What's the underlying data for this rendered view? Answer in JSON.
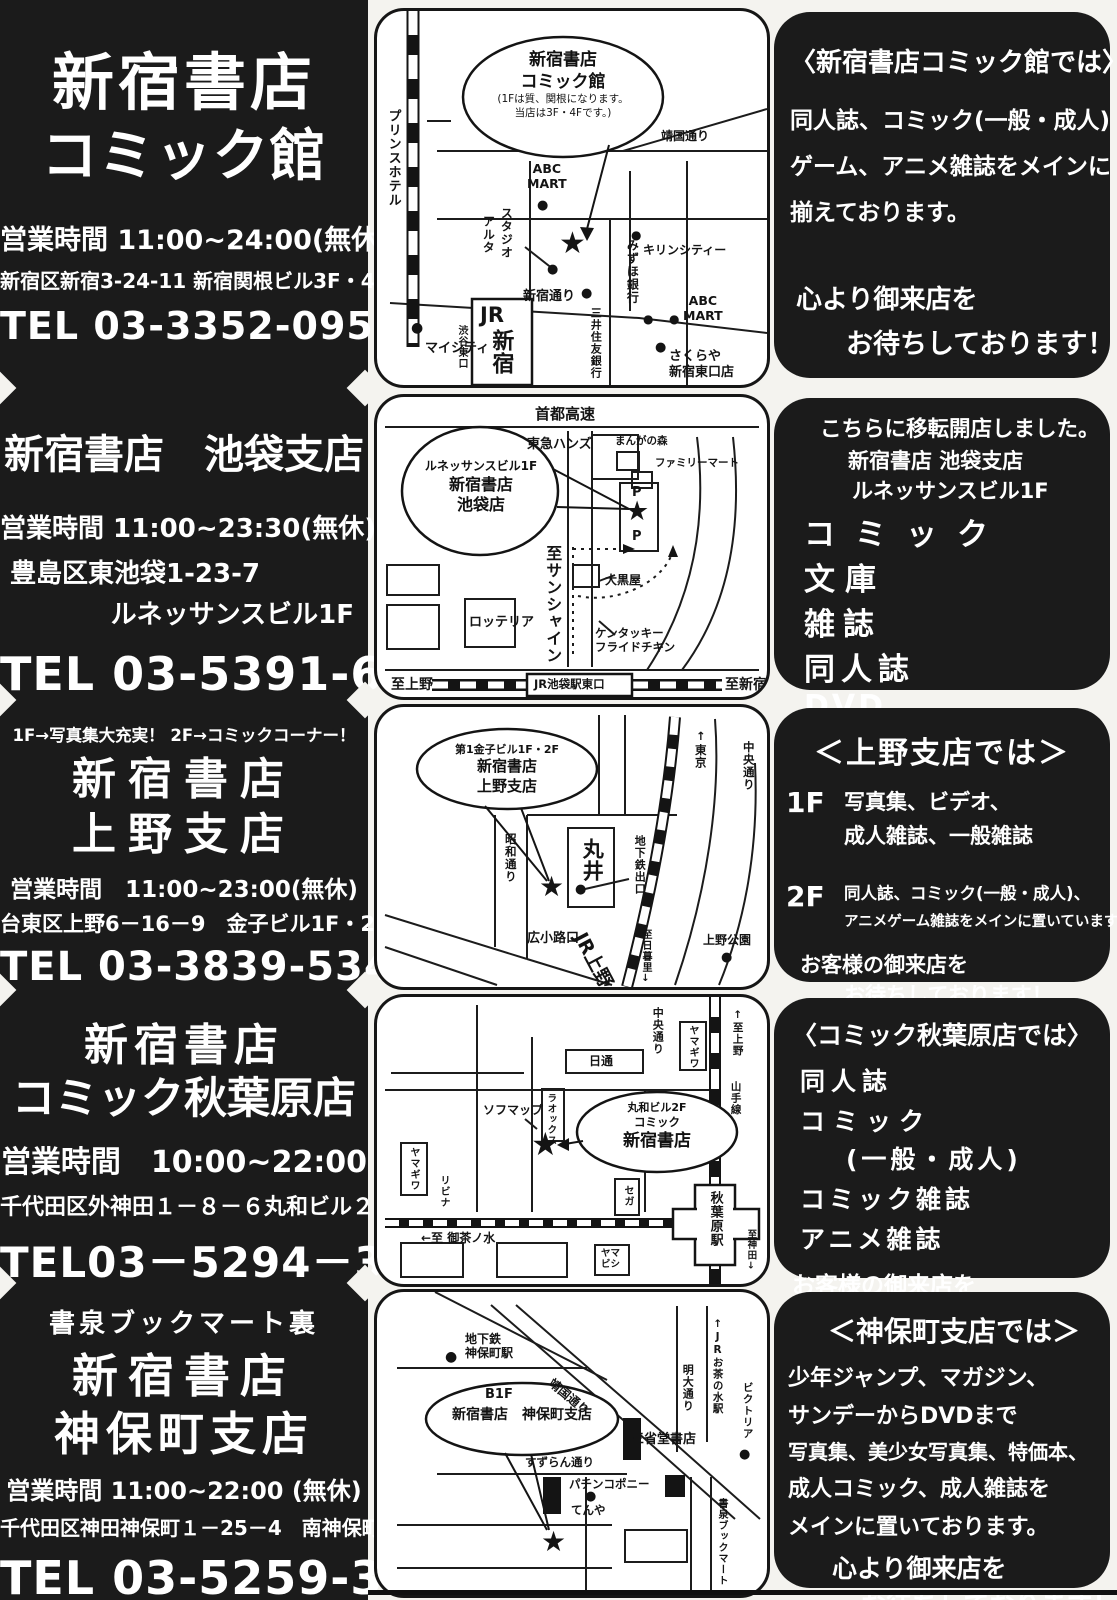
{
  "icons": {
    "star": "★",
    "dot": "●"
  },
  "stores": [
    {
      "title1": "新宿書店",
      "title2": "コミック館",
      "hours": "営業時間 11:00~24:00(無休)",
      "address1": "新宿区新宿3-24-11 新宿関根ビル3F・4F",
      "tel": "TEL 03-3352-0952"
    },
    {
      "title1": "新宿書店　池袋支店",
      "hours": "営業時間 11:00~23:30(無休)",
      "address1": "豊島区東池袋1-23-7",
      "address2": "ルネッサンスビル1F",
      "tel": "TEL 03-5391-6231"
    },
    {
      "note": "1F→写真集大充実！ 2F→コミックコーナー！",
      "title1": "新宿書店",
      "title2": "上野支店",
      "hours": "営業時間　11:00~23:00(無休)",
      "address1": "台東区上野6－16－9　金子ビル1F・2F",
      "tel": "TEL 03-3839-5340"
    },
    {
      "title1": "新宿書店",
      "title2": "コミック秋葉原店",
      "hours": "営業時間　10:00~22:00",
      "address1": "千代田区外神田１－８－６丸和ビル２F",
      "tel": "TEL03－5294－3222"
    },
    {
      "note": "書泉ブックマート裏",
      "title1": "新宿書店",
      "title2": "神保町支店",
      "hours": "営業時間 11:00~22:00 (無休)",
      "address1": "千代田区神田神保町１－25－4　南神保町ビルB1F",
      "tel": "TEL 03-5259-3525"
    }
  ],
  "maps": [
    {
      "balloon1": "新宿書店",
      "balloon2": "コミック館",
      "balloon3": "(1Fは質、関根になります。",
      "balloon4": "当店は3F・4Fです。)",
      "labels": {
        "prince": "プリンスホテル",
        "yasukuni": "靖国通り",
        "abc1": "ABC\nMART",
        "studio": "スタジオ",
        "alta": "アルタ",
        "mizuho": "みずほ銀行",
        "kirin": "キリンシティー",
        "abc2": "ABC\nMART",
        "shinjuku_dori": "新宿通り",
        "mitsui": "三井住友銀行",
        "mycity": "マイシティ",
        "jr": "JR",
        "shinjuku": "新宿",
        "shibuya": "渋谷東口",
        "sakuraya": "さくらや\n新宿東口店"
      }
    },
    {
      "balloon1": "ルネッサンスビル1F",
      "balloon2": "新宿書店",
      "balloon3": "池袋店",
      "labels": {
        "shuto": "首都高速",
        "tokyu": "東急ハンズ",
        "manga": "まんがの森",
        "famima": "ファミリーマート",
        "p1": "P",
        "p2": "P",
        "sunshine": "至サンシャイン",
        "daikoku": "大黒屋",
        "lotteria": "ロッテリア",
        "kfc": "ケンタッキー\nフライドチキン",
        "ueno": "至上野",
        "jrstation": "JR池袋駅東口",
        "shinjuku": "至新宿"
      }
    },
    {
      "balloon1": "第1金子ビル1F・2F",
      "balloon2": "新宿書店",
      "balloon3": "上野支店",
      "labels": {
        "tokyo": "↑東京",
        "chuo": "中央通り",
        "showa": "昭和通り",
        "marui": "丸井",
        "subway": "地下鉄出口",
        "hirokoji": "広小路口",
        "jrueno": "JR上野",
        "nippori": "至日暮里↓",
        "uenopark": "上野公園"
      }
    },
    {
      "balloon1": "丸和ビル2F",
      "balloon2": "コミック",
      "balloon3": "新宿書店",
      "labels": {
        "chuo": "中央通り",
        "yamagiwa1": "ヤマギワ",
        "ueno": "↑至上野",
        "yamanote": "山手線",
        "nittsu": "日通",
        "sofmap": "ソフマップ",
        "laox": "ラオックス",
        "yamagiwa2": "ヤマギワ",
        "livina": "リビナ",
        "sega": "セガ",
        "ochanomizu": "←至 御茶ノ水",
        "akihabara": "秋葉原駅",
        "kanda": "至神田↓",
        "yamabishi": "ヤマ\nビシ"
      }
    },
    {
      "balloon1": "B1F",
      "balloon2": "新宿書店　神保町支店",
      "labels": {
        "subway": "地下鉄\n神保町駅",
        "yasukuni": "靖国通り",
        "meidai": "明大通り",
        "jrochanomizu": "↑JRお茶の水駅",
        "victoria": "ビクトリア",
        "sanseido": "三省堂書店",
        "suzuran": "すずらん通り",
        "pachinko": "パチンコポニー",
        "tenya": "てんや",
        "shosen": "書泉ブックマート"
      }
    }
  ],
  "panels": [
    {
      "heading": "〈新宿書店コミック館では〉",
      "line1": "同人誌、コミック(一般・成人)",
      "line2": "ゲーム、アニメ雑誌をメインに",
      "line3": "揃えております。",
      "closing1": "心より御来店を",
      "closing2": "お待ちしております！"
    },
    {
      "intro": "こちらに移転開店しました。",
      "sub1": "新宿書店 池袋支店",
      "sub2": "ルネッサンスビル1F",
      "item1": "コミック",
      "item2": "文庫",
      "item3": "雑誌",
      "item4": "同人誌",
      "item5": "DVD",
      "closing1": "お客様の御来店を",
      "closing2": "お待ちしております！"
    },
    {
      "heading": "＜上野支店では＞",
      "floor1": "1F",
      "floor1a": "写真集、ビデオ、",
      "floor1b": "成人雑誌、一般雑誌",
      "floor2": "2F",
      "floor2a": "同人誌、コミック(一般・成人)、",
      "floor2b": "アニメゲーム雑誌をメインに置いています。",
      "closing1": "お客様の御来店を",
      "closing2": "お待ちしております！"
    },
    {
      "heading": "〈コミック秋葉原店では〉",
      "line1": "同人誌",
      "line2": "コミック",
      "line3": "(一般・成人)",
      "line4": "コミック雑誌",
      "line5": "アニメ雑誌",
      "closing1": "お客様の御来店を",
      "closing2": "お待ちしております！"
    },
    {
      "heading": "＜神保町支店では＞",
      "line1": "少年ジャンプ、マガジン、",
      "line2": "サンデーからDVDまで",
      "line3": "写真集、美少女写真集、特価本、",
      "line4": "成人コミック、成人雑誌を",
      "line5": "メインに置いております。",
      "closing1": "心より御来店を",
      "closing2": "お待ちしております！"
    }
  ]
}
